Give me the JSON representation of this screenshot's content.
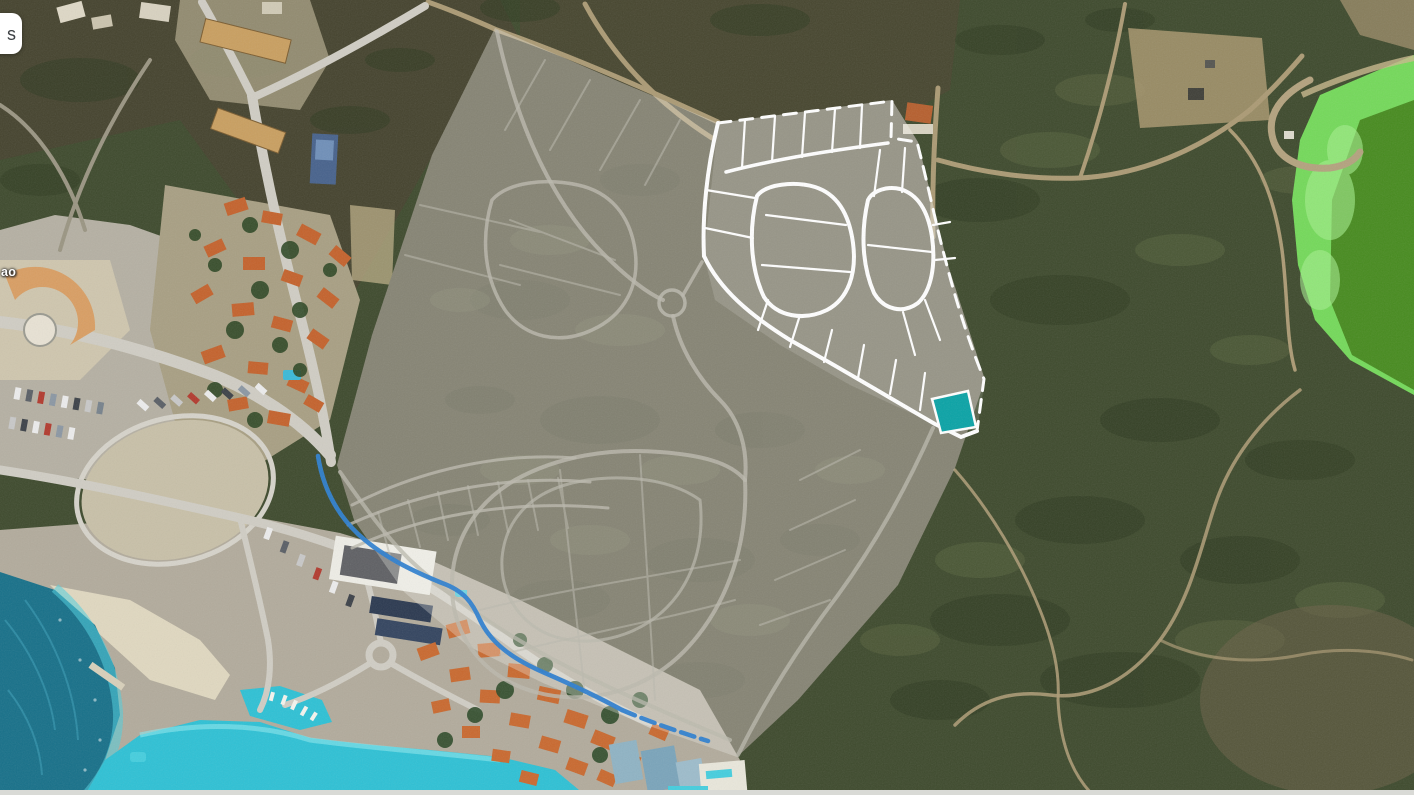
{
  "controls": {
    "partial_button_label": "s"
  },
  "map": {
    "place_label_partial": "ao",
    "colors": {
      "selected_plot": "#0aa3a6",
      "plot_boundary_lines": "#ffffff",
      "route_highlight": "#2e7fd0"
    }
  }
}
